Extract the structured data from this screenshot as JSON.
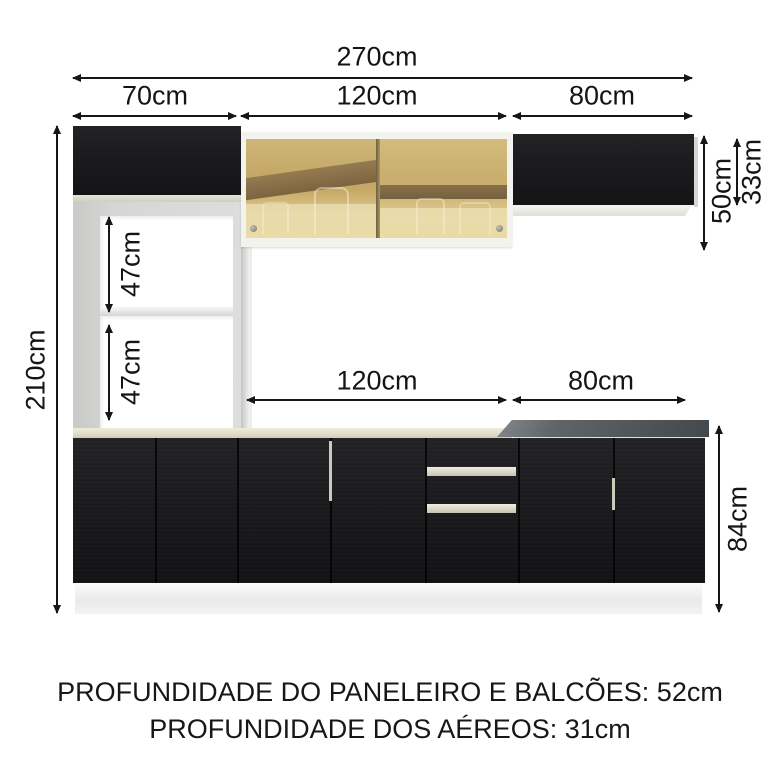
{
  "dims": {
    "w270": "270cm",
    "w70": "70cm",
    "w120_top": "120cm",
    "w80_top": "80cm",
    "w120_bottom": "120cm",
    "w80_bottom": "80cm",
    "h210": "210cm",
    "h47_top": "47cm",
    "h47_bottom": "47cm",
    "h50": "50cm",
    "h33": "33cm",
    "h84": "84cm"
  },
  "footer": {
    "line1": "PROFUNDIDADE DO PANELEIRO E BALCÕES: 52cm",
    "line2": "PROFUNDIDADE DOS AÉREOS: 31cm"
  },
  "colors": {
    "cabinet_black": "#1b1b1e",
    "frame_white": "#f2f2ef",
    "niche_gray": "#d3d3d1",
    "counter_cream": "#e2e0cf",
    "counter_gray": "#565b5f",
    "glass_amber": "#c9ad6e",
    "glass_band_brown": "#826943",
    "arrow": "#161616",
    "background": "#ffffff"
  }
}
